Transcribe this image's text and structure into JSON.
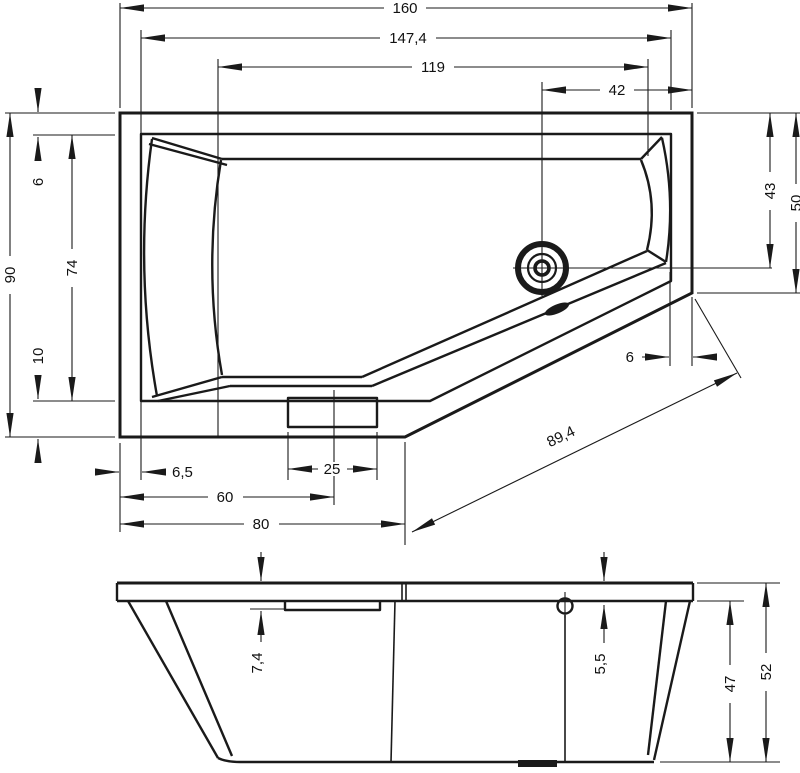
{
  "plan_dims": {
    "overall_width": "160",
    "inner_width": "147,4",
    "basin_width": "119",
    "drain_offset": "42",
    "overall_depth": "90",
    "rim_top_width": "6",
    "basin_depth": "74",
    "rim_bottom_width": "10",
    "drain_depth": "43",
    "corner_depth": "50",
    "diag_rim_width": "6",
    "diag_length": "89,4",
    "left_offset": "6,5",
    "headrest_width": "25",
    "headrest_center": "60",
    "front_width": "80"
  },
  "side_dims": {
    "headrest_drop": "7,4",
    "overflow_drop": "5,5",
    "shell_height": "47",
    "overall_height": "52"
  },
  "colors": {
    "line": "#1a1a1a",
    "background": "#ffffff"
  }
}
